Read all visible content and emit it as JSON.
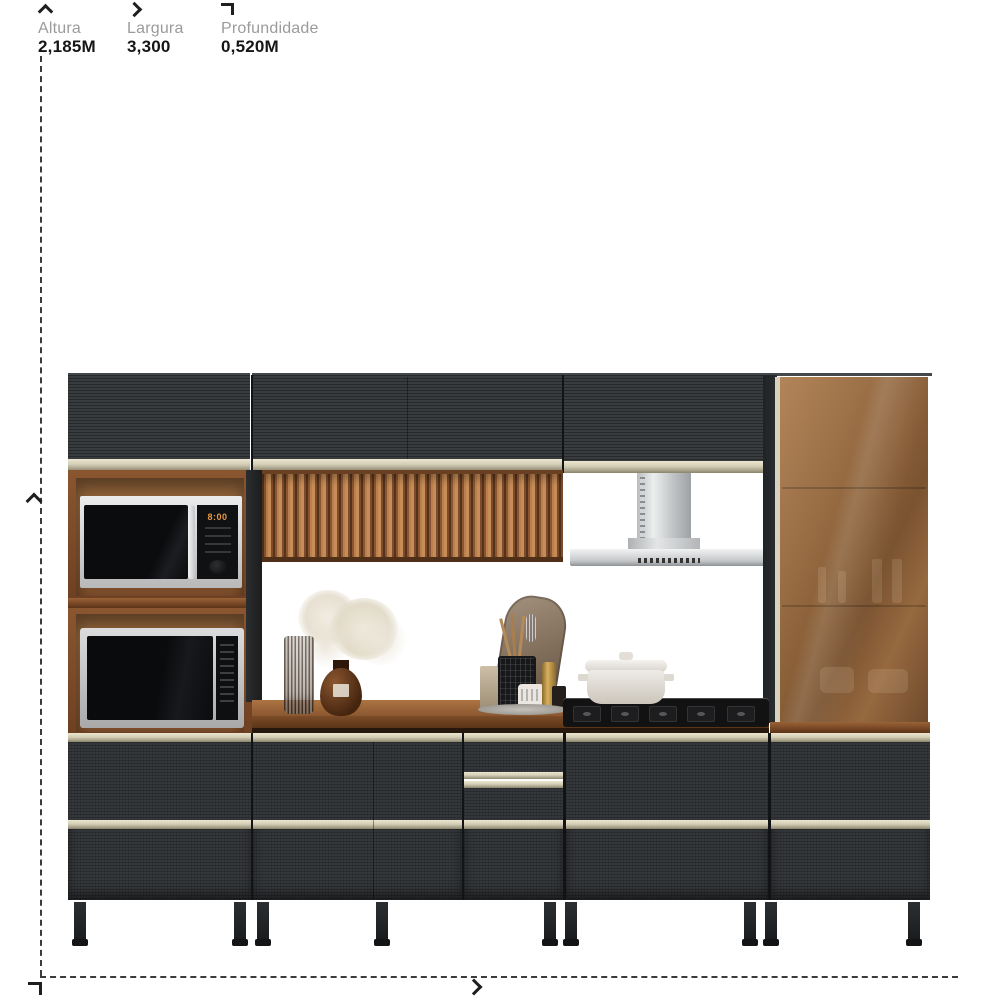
{
  "dimensions": {
    "altura": {
      "label": "Altura",
      "value": "2,185M",
      "icon": "chevron-up-icon"
    },
    "largura": {
      "label": "Largura",
      "value": "3,300",
      "icon": "chevron-right-icon"
    },
    "profundidade": {
      "label": "Profundidade",
      "value": "0,520M",
      "icon": "depth-corner-icon"
    }
  },
  "product": {
    "scene": "modular kitchen cabinet set render",
    "microwave_display": "8:00"
  },
  "colors": {
    "cabinet_dark": "#323537",
    "trim_champagne": "#d5ceb6",
    "wood_brown": "#8a5630",
    "glass_bronze": "#8a6038",
    "label_gray": "#9b9b9b",
    "value_black": "#161616",
    "background": "#ffffff"
  }
}
